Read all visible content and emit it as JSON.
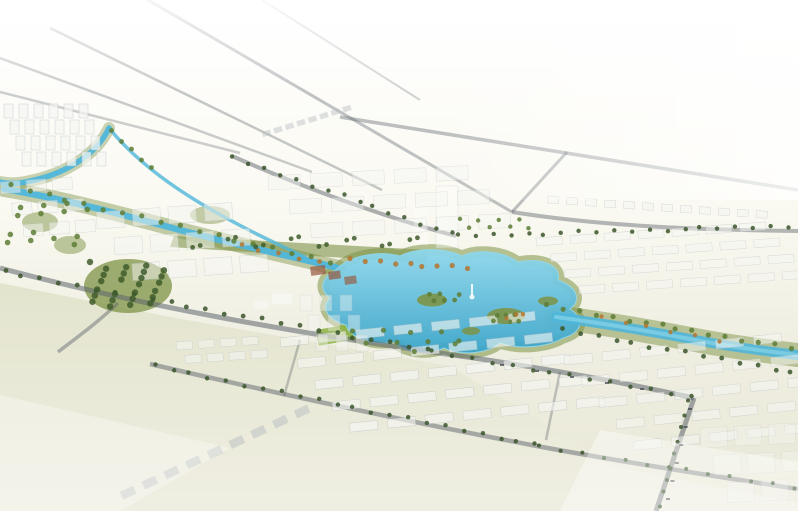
{
  "meta": {
    "type": "architectural-aerial-rendering",
    "description": "Bird's-eye perspective rendering of a planned urban district: a bright cyan central lake park with islands and a fountain monument, winding canals with green and autumn-colored banks, tree-lined boulevards, arterial roads radiating toward a white haze horizon at the top-left, ghosted white residential building rows across the middle and bottom-right, and a large pale open field at the bottom-left."
  },
  "palette": {
    "bg_top": "#ffffff",
    "bg_upper": "#faf9f1",
    "bg_mid": "#efeee1",
    "bg_low": "#e8e8d6",
    "field": "#e2e3cc",
    "field_light": "#f0efe3",
    "road": "#5d646b",
    "water": "#4fb6da",
    "water_light": "#8fd8ec",
    "water_deep": "#3ba5cb",
    "park": "#7d9346",
    "park_dark": "#3f5c2b",
    "lawn": "#8cb23f",
    "tree_dark": "#3a552a",
    "tree_green": "#5d7c35",
    "autumn": "#b5752f",
    "building": "#f6f7f4",
    "building_edge": "#b9bfc2",
    "roof_terracotta": "#96573d",
    "ghost": "#ffffff",
    "car": "#3d4248"
  },
  "scene": {
    "clusters": [
      {
        "name": "nw-towers",
        "x": 4,
        "y": 104,
        "cols": 6,
        "rows": 4,
        "dx": 15,
        "dy": 16,
        "shift": 6,
        "w": 9,
        "h": 14,
        "rot": 0,
        "op": 0.72
      },
      {
        "name": "west-blocks",
        "x": 96,
        "y": 212,
        "cols": 4,
        "rows": 3,
        "dx": 36,
        "dy": 27,
        "shift": 16,
        "w": 28,
        "h": 17,
        "rot": -4,
        "op": 0.5
      },
      {
        "name": "north-blocks",
        "x": 268,
        "y": 176,
        "cols": 5,
        "rows": 3,
        "dx": 42,
        "dy": 25,
        "shift": 20,
        "w": 32,
        "h": 14,
        "rot": -3,
        "op": 0.42
      },
      {
        "name": "distant-row",
        "x": 262,
        "y": 132,
        "cols": 8,
        "rows": 1,
        "dx": 12,
        "dy": 0,
        "shift": 0,
        "w": 8,
        "h": 5,
        "rot": -17,
        "op": 0.45,
        "fill": "building_edge"
      },
      {
        "name": "east-rows",
        "x": 536,
        "y": 238,
        "cols": 7,
        "rows": 4,
        "dx": 34,
        "dy": 17,
        "shift": 13,
        "w": 26,
        "h": 8,
        "rot": -4,
        "op": 0.5
      },
      {
        "name": "waterfront-villas",
        "x": 548,
        "y": 196,
        "cols": 12,
        "rows": 1,
        "dx": 19,
        "dy": 0,
        "shift": 0,
        "w": 11,
        "h": 7,
        "rot": 4,
        "op": 0.55
      },
      {
        "name": "south-rows",
        "x": 280,
        "y": 338,
        "cols": 7,
        "rows": 5,
        "dx": 38,
        "dy": 23,
        "shift": 15,
        "w": 28,
        "h": 9,
        "rot": -6,
        "op": 0.6
      },
      {
        "name": "southeast-rows",
        "x": 564,
        "y": 356,
        "cols": 6,
        "rows": 5,
        "dx": 38,
        "dy": 23,
        "shift": 15,
        "w": 28,
        "h": 9,
        "rot": -6,
        "op": 0.52
      },
      {
        "name": "far-corner-blocks",
        "x": 700,
        "y": 428,
        "cols": 3,
        "rows": 3,
        "dx": 34,
        "dy": 28,
        "shift": 12,
        "w": 27,
        "h": 20,
        "rot": -3,
        "op": 0.32
      },
      {
        "name": "lakeside-towers",
        "x": 300,
        "y": 295,
        "cols": 3,
        "rows": 3,
        "dx": 20,
        "dy": 20,
        "shift": 8,
        "w": 12,
        "h": 16,
        "rot": 0,
        "op": 0.4
      },
      {
        "name": "field-edge-row",
        "x": 120,
        "y": 492,
        "cols": 9,
        "rows": 1,
        "dx": 24,
        "dy": 0,
        "shift": 0,
        "w": 14,
        "h": 8,
        "rot": -25,
        "op": 0.5,
        "fill": "building_edge"
      },
      {
        "name": "west-edge-blocks",
        "x": 0,
        "y": 182,
        "cols": 3,
        "rows": 3,
        "dx": 26,
        "dy": 22,
        "shift": 10,
        "w": 20,
        "h": 12,
        "rot": -4,
        "op": 0.5
      },
      {
        "name": "boulevard-blocks",
        "x": 176,
        "y": 342,
        "cols": 4,
        "rows": 2,
        "dx": 22,
        "dy": 14,
        "shift": 8,
        "w": 16,
        "h": 8,
        "rot": -4,
        "op": 0.5
      }
    ],
    "tree_rows": [
      {
        "name": "upper-avenue-trees",
        "x1": 234,
        "y1": 158,
        "x2": 452,
        "y2": 234,
        "n": 15,
        "r": 2.2,
        "c": "tree_dark"
      },
      {
        "name": "east-avenue-trees",
        "x1": 458,
        "y1": 236,
        "x2": 788,
        "y2": 226,
        "n": 20,
        "r": 2.2,
        "c": "tree_dark"
      },
      {
        "name": "mid-boulevard-trees-west",
        "x1": 4,
        "y1": 272,
        "x2": 428,
        "y2": 350,
        "n": 24,
        "r": 2.4,
        "c": "tree_dark"
      },
      {
        "name": "mid-boulevard-trees-east",
        "x1": 432,
        "y1": 352,
        "x2": 690,
        "y2": 396,
        "n": 14,
        "r": 2.2,
        "c": "tree_dark"
      },
      {
        "name": "low-boulevard-trees-west",
        "x1": 154,
        "y1": 366,
        "x2": 536,
        "y2": 445,
        "n": 22,
        "r": 2.2,
        "c": "tree_dark"
      },
      {
        "name": "low-boulevard-trees-east",
        "x1": 540,
        "y1": 447,
        "x2": 794,
        "y2": 487,
        "n": 13,
        "r": 2.0,
        "c": "tree_dark"
      },
      {
        "name": "canal-bank-trees",
        "x1": 10,
        "y1": 186,
        "x2": 330,
        "y2": 262,
        "n": 18,
        "r": 2.6,
        "c": "tree_green"
      },
      {
        "name": "river-north-trees",
        "x1": 548,
        "y1": 306,
        "x2": 790,
        "y2": 348,
        "n": 16,
        "r": 2.6,
        "c": "tree_green"
      },
      {
        "name": "river-south-trees",
        "x1": 562,
        "y1": 330,
        "x2": 792,
        "y2": 372,
        "n": 14,
        "r": 2.4,
        "c": "tree_dark"
      },
      {
        "name": "right-road-trees",
        "x1": 690,
        "y1": 402,
        "x2": 658,
        "y2": 506,
        "n": 9,
        "r": 2.0,
        "c": "tree_dark"
      },
      {
        "name": "lake-north-autumn-trees",
        "x1": 350,
        "y1": 260,
        "x2": 468,
        "y2": 268,
        "n": 9,
        "r": 2.6,
        "c": "autumn"
      },
      {
        "name": "canal-autumn-trees",
        "x1": 240,
        "y1": 246,
        "x2": 320,
        "y2": 262,
        "n": 5,
        "r": 2.4,
        "c": "autumn"
      },
      {
        "name": "upper-canal-trees",
        "x1": 112,
        "y1": 132,
        "x2": 150,
        "y2": 168,
        "n": 5,
        "r": 2.4,
        "c": "tree_green"
      },
      {
        "name": "river-autumn-trees",
        "x1": 600,
        "y1": 318,
        "x2": 720,
        "y2": 340,
        "n": 6,
        "r": 2.2,
        "c": "autumn"
      }
    ],
    "scatters": [
      {
        "name": "west-park-trees",
        "x": 90,
        "y": 262,
        "w": 78,
        "h": 46,
        "n": 26,
        "r": 3.2,
        "c": "park_dark"
      },
      {
        "name": "west-blocks-greens",
        "x": 2,
        "y": 196,
        "w": 90,
        "h": 60,
        "n": 14,
        "r": 2.8,
        "c": "tree_green"
      },
      {
        "name": "island-trees-1",
        "x": 420,
        "y": 293,
        "w": 40,
        "h": 12,
        "n": 6,
        "r": 2.4,
        "c": "tree_green"
      },
      {
        "name": "island-trees-2",
        "x": 492,
        "y": 310,
        "w": 34,
        "h": 12,
        "n": 6,
        "r": 2.4,
        "c": "tree_green"
      },
      {
        "name": "island-autumn-trees",
        "x": 498,
        "y": 312,
        "w": 26,
        "h": 8,
        "n": 3,
        "r": 2.2,
        "c": "autumn"
      },
      {
        "name": "lake-south-trees",
        "x": 350,
        "y": 330,
        "w": 120,
        "h": 22,
        "n": 10,
        "r": 2.6,
        "c": "tree_green"
      },
      {
        "name": "north-strip-trees",
        "x": 180,
        "y": 234,
        "w": 245,
        "h": 14,
        "n": 16,
        "r": 2.4,
        "c": "park_dark"
      },
      {
        "name": "junction-greens",
        "x": 460,
        "y": 216,
        "w": 80,
        "h": 16,
        "n": 8,
        "r": 2.2,
        "c": "tree_green"
      }
    ],
    "cars": [
      {
        "name": "right-road-traffic",
        "x1": 688,
        "y1": 408,
        "x2": 666,
        "y2": 498,
        "n": 6
      },
      {
        "name": "mid-boulevard-traffic",
        "x1": 500,
        "y1": 364,
        "x2": 640,
        "y2": 388,
        "n": 5
      }
    ]
  }
}
